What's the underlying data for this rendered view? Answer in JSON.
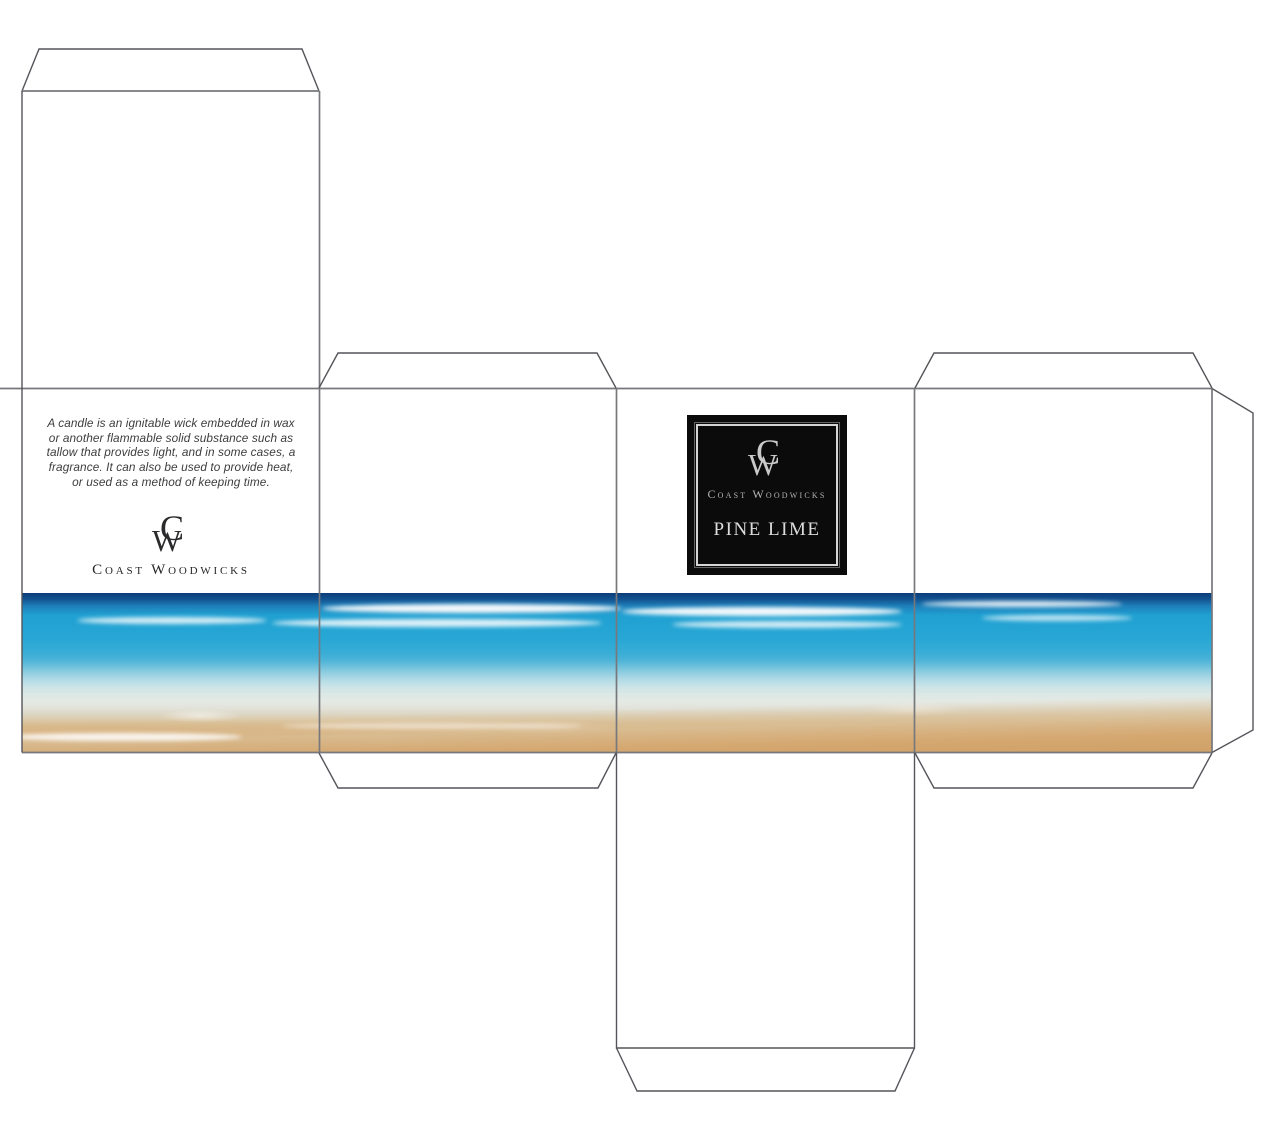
{
  "back_panel": {
    "description_lines": [
      "A candle is an ignitable wick embedded in wax",
      "or another flammable solid substance such as",
      "tallow that provides light, and in some cases, a",
      "fragrance. It can also be used to provide heat,",
      "or used as a method of keeping time."
    ],
    "monogram_c": "C",
    "monogram_w": "W",
    "brand": "Coast Woodwicks"
  },
  "front_label": {
    "monogram_c": "C",
    "monogram_w": "W",
    "brand": "Coast Woodwicks",
    "scent": "PINE LIME",
    "background_color": "#0b0b0c",
    "frame_color": "#d4d4d4",
    "brand_text_color": "#b3b3b3",
    "scent_text_color": "#dcdcdc"
  },
  "artwork": {
    "name": "beach-shoreline-photo",
    "colors": {
      "horizon_navy": "#0b3c7a",
      "ocean_blue": "#20a0d1",
      "turquoise": "#63bcd9",
      "foam_white": "#f2f8f9",
      "sand": "#d5a871"
    }
  },
  "dieline": {
    "cut_line_color": "#54555a",
    "fold_line_color": "#77787c"
  }
}
